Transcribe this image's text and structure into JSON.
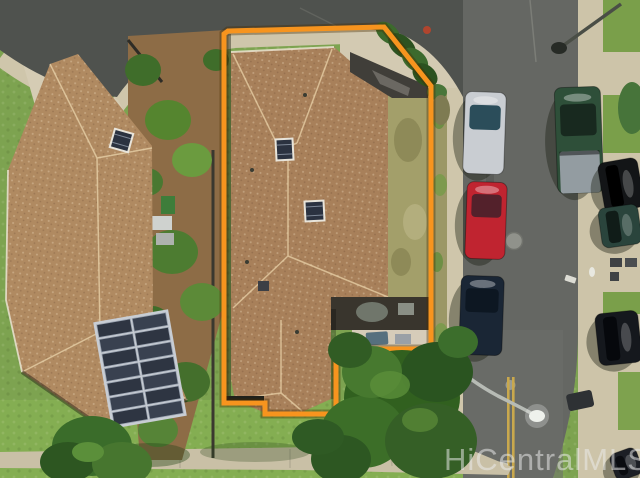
{
  "watermark": {
    "text": "HiCentralMLS",
    "color": "#ededed"
  },
  "boundary": {
    "points": "228,31 384,27 431,86 431,349 336,349 336,414 265,414 265,403 224,403 224,34",
    "color": "#F7941E",
    "halo_color": "rgba(70,45,0,0.38)",
    "stroke_width": "5"
  },
  "solar_array": {
    "x": 104,
    "y": 317,
    "width": 72,
    "height": 104,
    "rows": 7,
    "cols": 2,
    "rotate": -10,
    "panel_color": "#394150",
    "cell_color": "#2e3542",
    "grid_color": "#9aa3b0",
    "frame_color": "#c8cdd4"
  },
  "skylights": [
    {
      "name": "subject-roof-skylight-upper",
      "x": 277,
      "y": 140,
      "w": 15,
      "h": 19,
      "rot": -3
    },
    {
      "name": "subject-roof-skylight-lower",
      "x": 306,
      "y": 202,
      "w": 17,
      "h": 18,
      "rot": -3
    },
    {
      "name": "neighbor-roof-skylight",
      "x": 113,
      "y": 132,
      "w": 17,
      "h": 17,
      "rot": 16
    }
  ],
  "cars": [
    {
      "name": "silver-car",
      "x": 464,
      "y": 92,
      "w": 41,
      "h": 82,
      "rot": 2,
      "dir": "v",
      "body": "#c9cdd2",
      "glass": "#2b4d5a"
    },
    {
      "name": "red-car",
      "x": 466,
      "y": 182,
      "w": 40,
      "h": 77,
      "rot": 2,
      "dir": "v",
      "body": "#c02430",
      "glass": "#53212b"
    },
    {
      "name": "navy-car",
      "x": 460,
      "y": 276,
      "w": 43,
      "h": 79,
      "rot": 2,
      "dir": "v",
      "body": "#1a2635",
      "glass": "#0d1722"
    },
    {
      "name": "green-pickup-truck",
      "x": 556,
      "y": 87,
      "w": 46,
      "h": 106,
      "rot": -2,
      "dir": "v",
      "body": "#2e4f39",
      "glass": "#18291f",
      "bed": "#939ca1",
      "bed_h": 42
    },
    {
      "name": "black-suv",
      "x": 601,
      "y": 160,
      "w": 40,
      "h": 50,
      "rot": -10,
      "dir": "h",
      "body": "#131517",
      "glass": "#000000"
    },
    {
      "name": "dark-teal-car",
      "x": 600,
      "y": 206,
      "w": 40,
      "h": 40,
      "rot": -8,
      "dir": "h",
      "body": "#2a443c",
      "glass": "#101c18"
    },
    {
      "name": "black-car",
      "x": 597,
      "y": 312,
      "w": 43,
      "h": 52,
      "rot": -6,
      "dir": "h",
      "body": "#15181d",
      "glass": "#06080c"
    },
    {
      "name": "parked-car-corner",
      "x": 612,
      "y": 450,
      "w": 28,
      "h": 28,
      "rot": -20,
      "dir": "h",
      "body": "#1c1f25",
      "glass": "#0a0c10"
    }
  ],
  "street": {
    "center_line_color": "#c9a84d",
    "lamp_head_color": "#eef1ec",
    "manhole_color": "#90928b"
  }
}
